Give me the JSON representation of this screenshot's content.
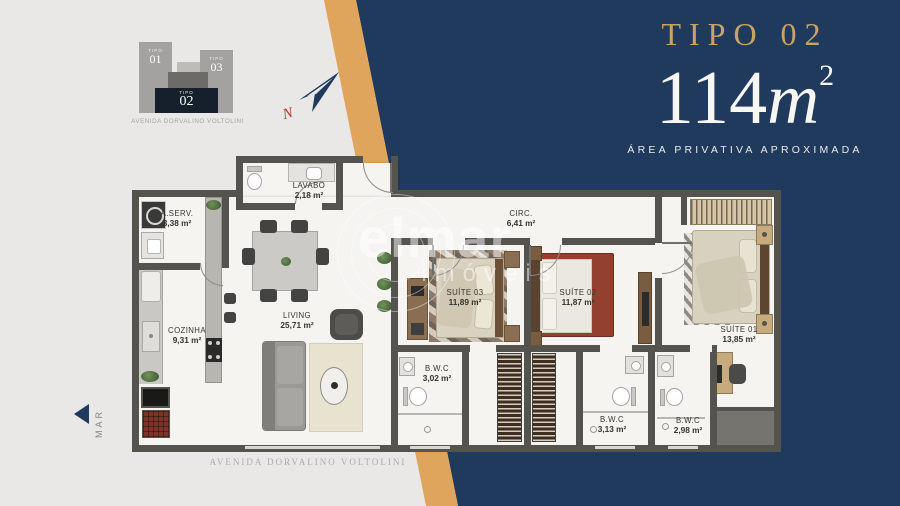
{
  "title_block": {
    "type_label": "TIPO 02",
    "area_value": "114",
    "area_unit": "m",
    "area_exponent": "2",
    "area_caption": "ÁREA PRIVATIVA APROXIMADA"
  },
  "key_plan": {
    "street": "AVENIDA DORVALINO VOLTOLINI",
    "blocks": [
      {
        "label": "TIPO",
        "number": "01"
      },
      {
        "label": "TIPO",
        "number": "03"
      },
      {
        "label": "TIPO",
        "number": "02"
      }
    ]
  },
  "compass": {
    "north_label": "N"
  },
  "orientation": {
    "sea_label": "MAR"
  },
  "street_label": "AVENIDA DORVALINO VOLTOLINI",
  "watermark": {
    "line1": "elmar",
    "line2": "imóveis"
  },
  "rooms": {
    "aserv": {
      "name": "A.SERV.",
      "area": "3,38 m²"
    },
    "lavabo": {
      "name": "LAVABO",
      "area": "2,18 m²"
    },
    "cozinha": {
      "name": "COZINHA",
      "area": "9,31 m²"
    },
    "living": {
      "name": "LIVING",
      "area": "25,71 m²"
    },
    "circ": {
      "name": "CIRC.",
      "area": "6,41 m²"
    },
    "suite03": {
      "name": "SUÍTE 03",
      "area": "11,89 m²"
    },
    "suite02": {
      "name": "SUÍTE 02",
      "area": "11,87 m²"
    },
    "suite01": {
      "name": "SUÍTE 01",
      "area": "13,85 m²"
    },
    "bwc302": {
      "name": "B.W.C",
      "area": "3,02 m²"
    },
    "bwc313": {
      "name": "B.W.C",
      "area": "3,13 m²"
    },
    "bwc298": {
      "name": "B.W.C",
      "area": "2,98 m²"
    }
  },
  "colors": {
    "navy": "#1f3a5c",
    "gold_stripe": "#dfa55c",
    "title_gold": "#c9a267",
    "wall": "#55534e",
    "floor": "#f5f4f1",
    "north_red": "#b5372c"
  }
}
